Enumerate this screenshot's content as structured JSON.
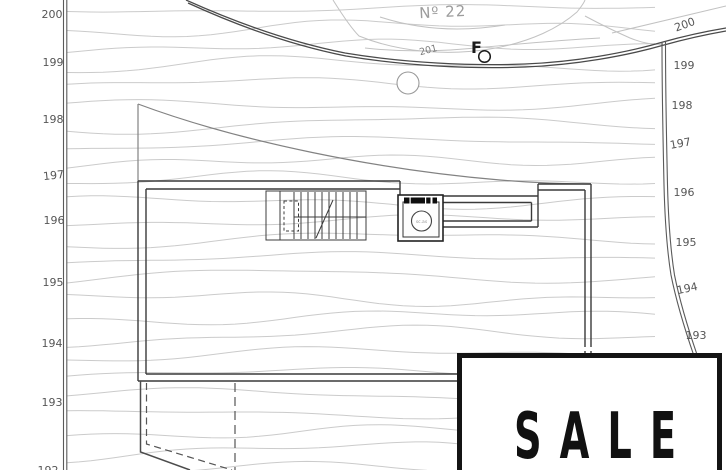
{
  "plan": {
    "neighbor_plot_label": "Nº 22",
    "road_level_label": "201",
    "benchmark_label": "F",
    "elevator_cab_label": "sc.as",
    "sale_banner": "SALE",
    "levels_left": [
      "200",
      "199",
      "198",
      "197",
      "196",
      "195",
      "194",
      "193",
      "192"
    ],
    "levels_right": [
      "200",
      "199",
      "198",
      "197",
      "196",
      "195",
      "194",
      "193"
    ],
    "colors": {
      "contour": "#cbcbcb",
      "boundary": "#5a5a5a",
      "wall": "#3a3a3a",
      "level_label": "#565656",
      "muted_label": "#9c9c9c",
      "sale_border": "#141414",
      "sale_text": "#111111"
    }
  }
}
